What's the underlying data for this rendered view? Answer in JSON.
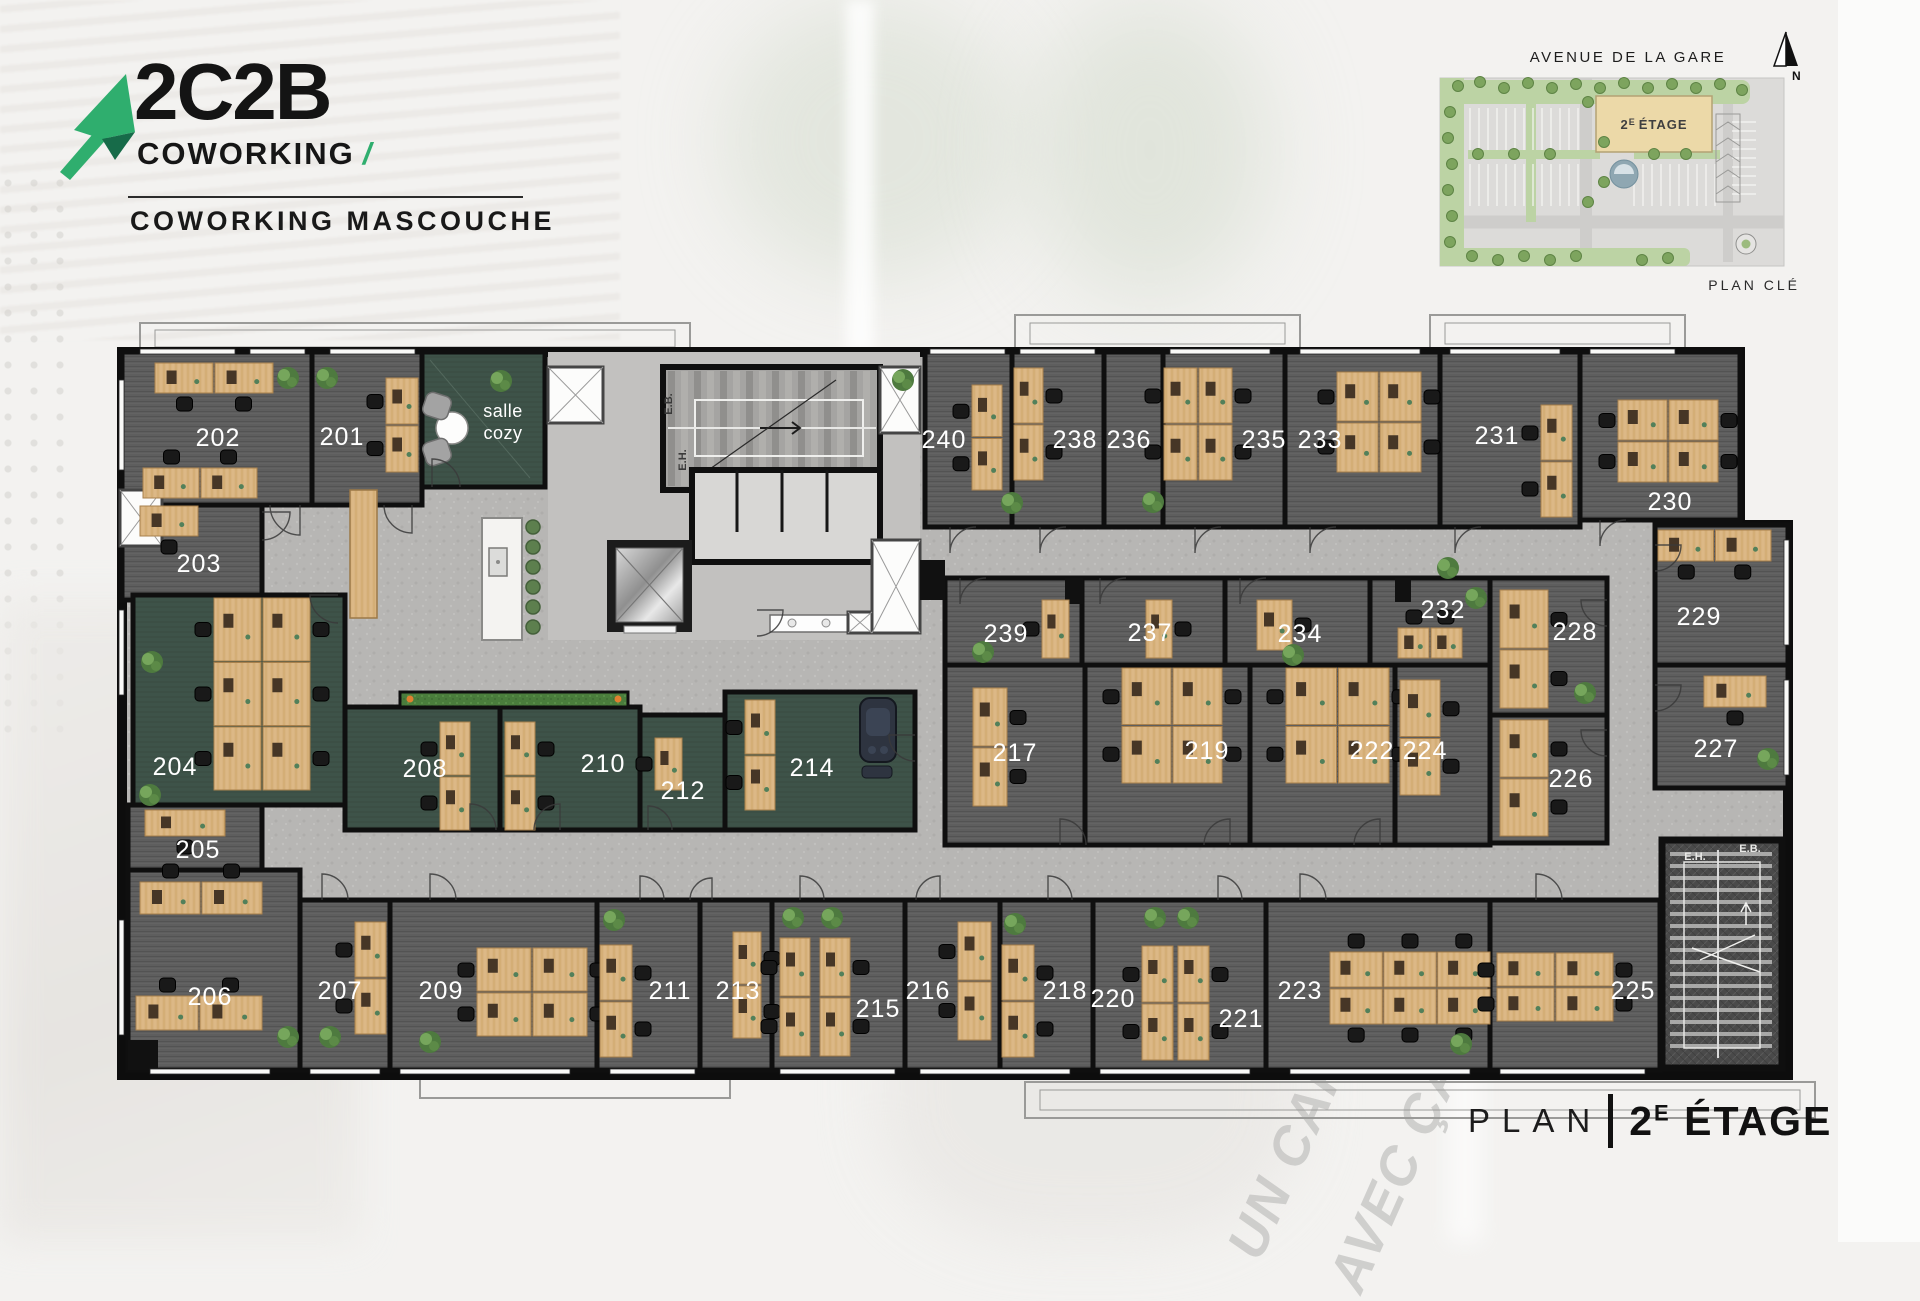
{
  "branding": {
    "logo_main": "2C2B",
    "logo_sub": "COWORKING",
    "logo_slash": "/",
    "site_title": "COWORKING MASCOUCHE"
  },
  "key_plan": {
    "street": "AVENUE DE LA GARE",
    "floor_num": "2",
    "floor_sup": "E",
    "floor_word": "ÉTAGE",
    "caption": "PLAN CLÉ",
    "north": "N"
  },
  "title": {
    "label": "PLAN",
    "floor_num": "2",
    "floor_sup": "E",
    "floor_word": "ÉTAGE"
  },
  "watermark": {
    "line1": "UN CAFÉ",
    "line2": "AVEC ÇA"
  },
  "floor_plan": {
    "cozy_line1": "salle",
    "cozy_line2": "cozy",
    "stair_top_up": "E.B.",
    "stair_top_down": "E.H.",
    "stair_bottom_left": "E.H.",
    "stair_bottom_right": "E.B.",
    "rooms": [
      {
        "number": "202",
        "x": 218,
        "y": 437
      },
      {
        "number": "201",
        "x": 342,
        "y": 436
      },
      {
        "number": "203",
        "x": 199,
        "y": 563
      },
      {
        "number": "240",
        "x": 944,
        "y": 439
      },
      {
        "number": "238",
        "x": 1075,
        "y": 439
      },
      {
        "number": "236",
        "x": 1129,
        "y": 439
      },
      {
        "number": "235",
        "x": 1264,
        "y": 439
      },
      {
        "number": "233",
        "x": 1320,
        "y": 439
      },
      {
        "number": "231",
        "x": 1497,
        "y": 435
      },
      {
        "number": "230",
        "x": 1670,
        "y": 501
      },
      {
        "number": "229",
        "x": 1699,
        "y": 616
      },
      {
        "number": "228",
        "x": 1575,
        "y": 631
      },
      {
        "number": "232",
        "x": 1443,
        "y": 609
      },
      {
        "number": "234",
        "x": 1300,
        "y": 633
      },
      {
        "number": "237",
        "x": 1150,
        "y": 632
      },
      {
        "number": "239",
        "x": 1006,
        "y": 633
      },
      {
        "number": "227",
        "x": 1716,
        "y": 748
      },
      {
        "number": "226",
        "x": 1571,
        "y": 778
      },
      {
        "number": "224",
        "x": 1425,
        "y": 750
      },
      {
        "number": "222",
        "x": 1372,
        "y": 750
      },
      {
        "number": "219",
        "x": 1207,
        "y": 750
      },
      {
        "number": "217",
        "x": 1015,
        "y": 752
      },
      {
        "number": "204",
        "x": 175,
        "y": 766
      },
      {
        "number": "205",
        "x": 198,
        "y": 849
      },
      {
        "number": "208",
        "x": 425,
        "y": 768
      },
      {
        "number": "210",
        "x": 603,
        "y": 763
      },
      {
        "number": "212",
        "x": 683,
        "y": 790
      },
      {
        "number": "214",
        "x": 812,
        "y": 767
      },
      {
        "number": "206",
        "x": 210,
        "y": 996
      },
      {
        "number": "207",
        "x": 340,
        "y": 990
      },
      {
        "number": "209",
        "x": 441,
        "y": 990
      },
      {
        "number": "211",
        "x": 670,
        "y": 990
      },
      {
        "number": "213",
        "x": 738,
        "y": 990
      },
      {
        "number": "215",
        "x": 878,
        "y": 1008
      },
      {
        "number": "216",
        "x": 928,
        "y": 990
      },
      {
        "number": "218",
        "x": 1065,
        "y": 990
      },
      {
        "number": "220",
        "x": 1113,
        "y": 998
      },
      {
        "number": "221",
        "x": 1241,
        "y": 1018
      },
      {
        "number": "223",
        "x": 1300,
        "y": 990
      },
      {
        "number": "225",
        "x": 1633,
        "y": 990
      }
    ]
  }
}
